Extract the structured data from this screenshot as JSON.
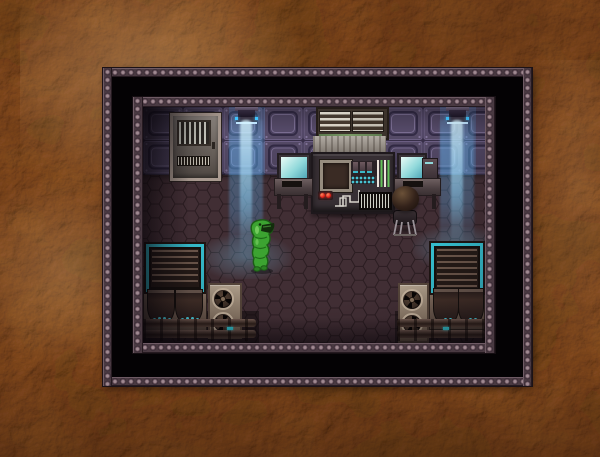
{
  "window": {
    "label": "retro RPG game window with riveted metal double frame",
    "frame": {
      "outer_metal": "#46363e",
      "rivet_highlight": "#a08a92",
      "gap_color": "#040204",
      "inner_metal": "#4c3b42"
    }
  },
  "background": {
    "label": "mottled rocky martian-brown desktop texture",
    "base_color": "#8a5f3c",
    "highlight_color": "#eecb98",
    "shadow_color": "#231006"
  },
  "scene": {
    "label": "top-down sci-fi laboratory room",
    "wall_color": "#564b68",
    "floor_color": "#45313a",
    "floor_pattern": "hexagonal tiles",
    "accent_colors": {
      "beam_blue": "#6ec8ff",
      "cyan_trim": "#35bccc",
      "alert_red": "#e02018",
      "bar_green": "#63c05a",
      "monitor_teal": "#8fd8da"
    },
    "entities": [
      {
        "id": "door",
        "label": "metal security door with barred window and vent"
      },
      {
        "id": "ceiling-light-left",
        "label": "wall-mounted projector casting blue light beam"
      },
      {
        "id": "ceiling-light-right",
        "label": "wall-mounted projector casting blue light beam"
      },
      {
        "id": "air-vent",
        "label": "large twin wall air vent with pale slats"
      },
      {
        "id": "exhaust-hood",
        "label": "streaked metal exhaust hood above console"
      },
      {
        "id": "control-console",
        "label": "control console with screen, switches, teal dot grid, green status bars, red warning lights, circuit trace and barcode panel"
      },
      {
        "id": "workstation-left",
        "label": "computer desk with teal-screen monitor and keyboard"
      },
      {
        "id": "workstation-right",
        "label": "computer desk with teal-screen monitor, keyboard and tower unit"
      },
      {
        "id": "scientist",
        "label": "dark-haired character seated on a stool at the right workstation"
      },
      {
        "id": "alien-creature",
        "label": "green slime-lizard creature standing on the floor"
      },
      {
        "id": "cooler-left",
        "label": "cooling machine with cyan-framed grille and twin dark tanks"
      },
      {
        "id": "cooler-right",
        "label": "cooling machine with cyan-framed grille and twin dark tanks"
      },
      {
        "id": "fan-unit-left",
        "label": "vertical double-fan ventilation unit"
      },
      {
        "id": "fan-unit-right",
        "label": "vertical double-fan ventilation unit"
      },
      {
        "id": "pipes-left",
        "label": "horizontal floor pipes with couplings and cyan valve light"
      },
      {
        "id": "pipes-right",
        "label": "horizontal floor pipes with couplings and cyan valve light"
      }
    ]
  }
}
